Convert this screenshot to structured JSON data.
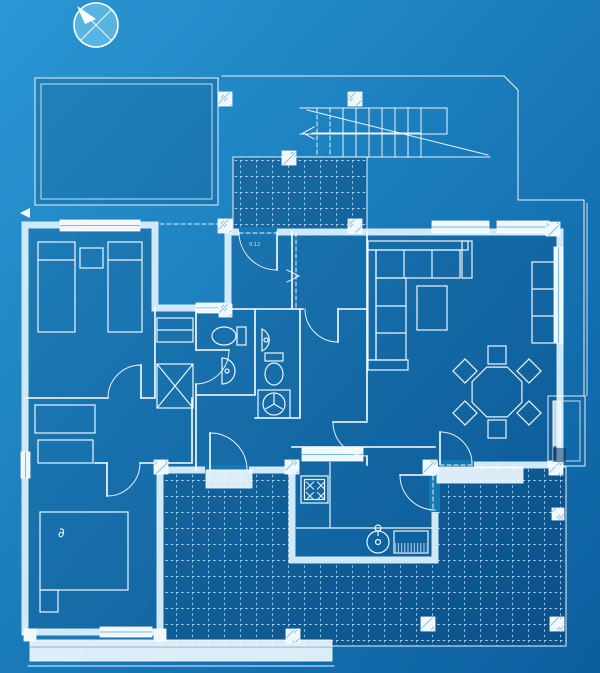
{
  "meta": {
    "width": 600,
    "height": 673,
    "kind": "blueprint-floor-plan"
  },
  "colors": {
    "background-top-left": "#2a97d4",
    "background-bottom-right": "#0a5e9e",
    "line-white": "#ffffff",
    "line-soft": "#bfe2f4",
    "wall-band": "#cfe9f8",
    "window-fill": "#eef8fe",
    "window-inner": "#79b9de",
    "room-shade": "rgba(6,50,92,0.18)",
    "terrace-shade": "rgba(6,50,92,0.32)",
    "door-gap": "#1379b7",
    "compass-fill": "#58b4e1",
    "hatch-line": "#8fc3e2",
    "grid-line": "#dff1fb"
  },
  "labels": {
    "entry_dimension": "9.12",
    "bed_glyph": "∂"
  },
  "compass": {
    "icon": "compass-rose-icon",
    "arrow_direction": "north-west"
  },
  "site": {
    "features": [
      "property-boundary",
      "garage",
      "exterior-stair",
      "entry-porch",
      "walkway-dashed-path",
      "terrace-tiled",
      "garden-steps",
      "side-annex"
    ]
  },
  "house": {
    "rooms": [
      "bedroom-twin",
      "bedroom-master",
      "hallway",
      "bathroom-small",
      "bathroom-wc-laundry",
      "entry-hall",
      "stair-hall",
      "living-dining-room",
      "kitchen"
    ],
    "furniture": [
      "twin-bed",
      "twin-bed",
      "nightstand",
      "wardrobe-x",
      "shelf",
      "double-bed",
      "dresser",
      "dresser",
      "corner-sofa",
      "coffee-table",
      "sideboard",
      "dining-table-octagon",
      "chair",
      "chair",
      "chair",
      "chair",
      "chair",
      "chair",
      "stove-4-burner",
      "kitchen-sink",
      "drainer",
      "toilet",
      "toilet",
      "washbasin",
      "washbasin",
      "washing-machine"
    ]
  }
}
